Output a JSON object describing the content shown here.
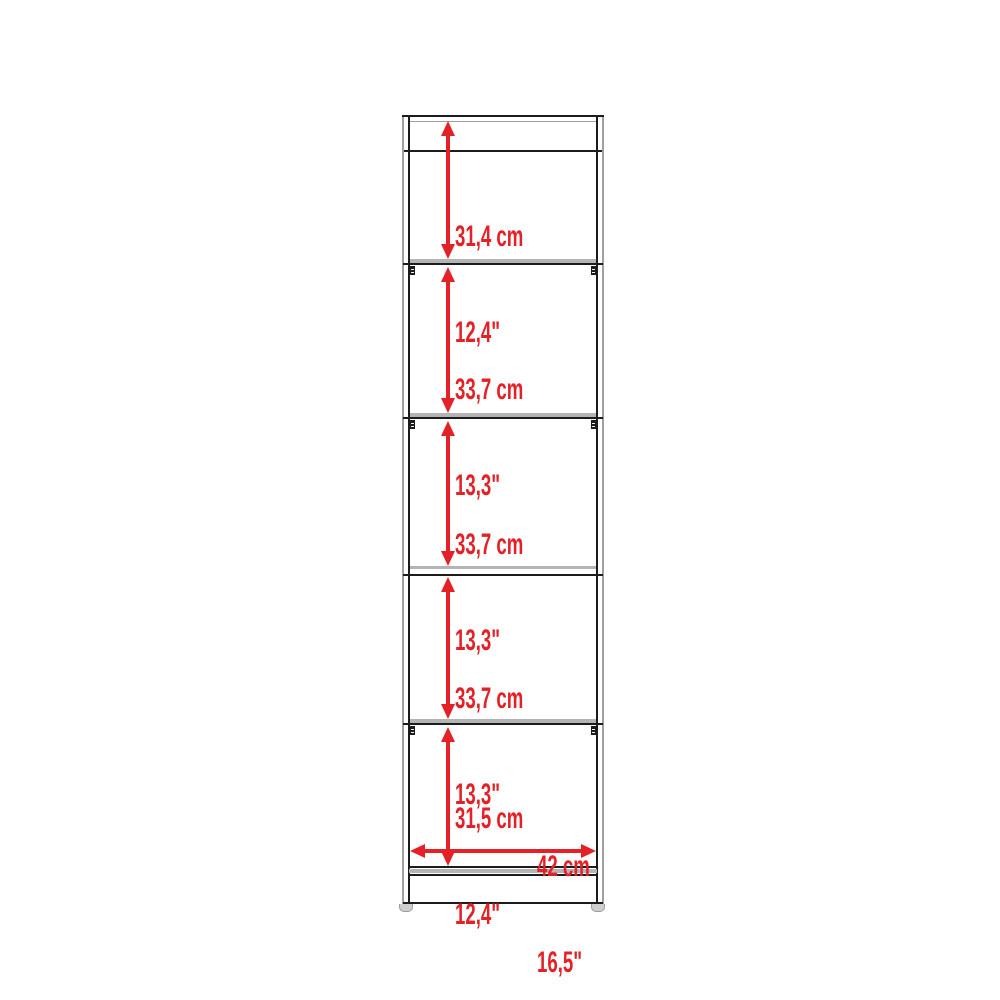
{
  "colors": {
    "dimension_red": "#e32126",
    "line_dark": "#1c1c1c",
    "line_gray": "#a0a0a0",
    "shelf_gray": "#b4b4b4"
  },
  "sections": [
    {
      "cm": "31,4 cm",
      "inch": "12,4\""
    },
    {
      "cm": "33,7 cm",
      "inch": "13,3\""
    },
    {
      "cm": "33,7 cm",
      "inch": "13,3\""
    },
    {
      "cm": "33,7 cm",
      "inch": "13,3\""
    },
    {
      "cm": "31,5 cm",
      "inch": "12,4\""
    }
  ],
  "width_dimension": {
    "cm": "42 cm",
    "inch": "16,5\""
  }
}
